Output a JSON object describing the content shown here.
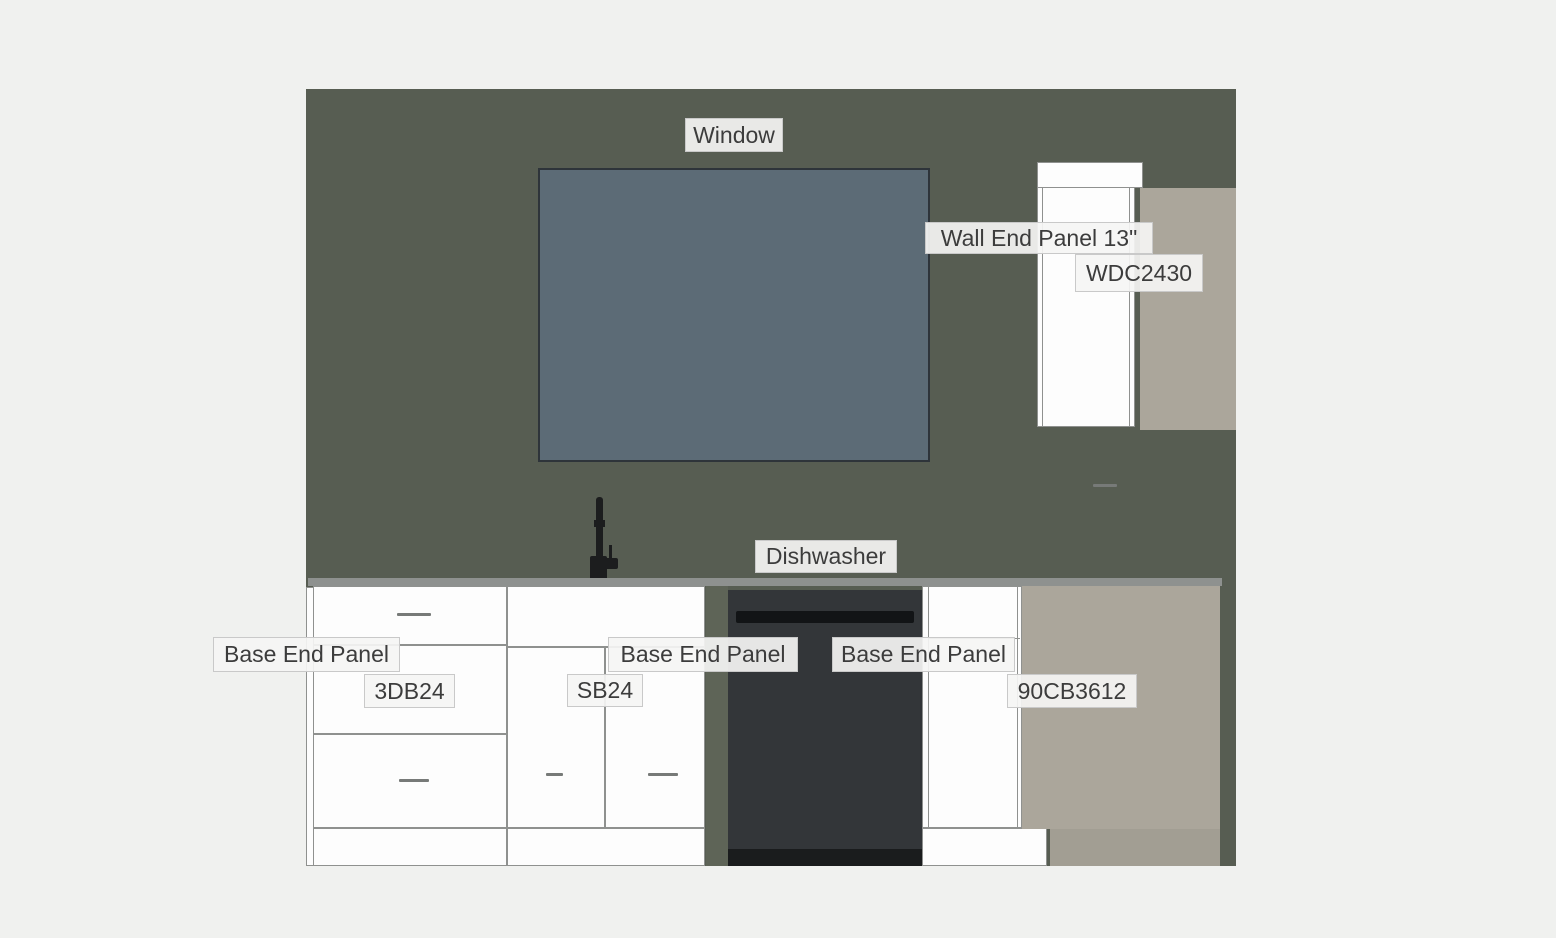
{
  "labels": {
    "window": "Window",
    "wall_end_panel": "Wall End Panel 13\"",
    "wdc2430": "WDC2430",
    "dishwasher": "Dishwasher",
    "base_end_panel_left": "Base End Panel",
    "base_end_panel_mid": "Base End Panel",
    "base_end_panel_right": "Base End Panel",
    "drawer_base": "3DB24",
    "sink_base": "SB24",
    "corner_base": "90CB3612"
  },
  "colors": {
    "page_background": "#f0f1ef",
    "wall": "#575d52",
    "window_fill": "#5c6b76",
    "window_border": "#2e343a",
    "cabinet_white": "#fdfdfd",
    "cabinet_outline": "#8f918f",
    "countertop": "#8e918f",
    "end_panel_beige": "#aba69b",
    "end_panel_beige_toe": "#a29e93",
    "dishwasher_body": "#333639",
    "dishwasher_band": "#141618",
    "faucet": "#1c1d1e",
    "label_background": "#f5f5f4",
    "label_border": "#c9c9c9",
    "label_text": "#3c3c3c"
  }
}
